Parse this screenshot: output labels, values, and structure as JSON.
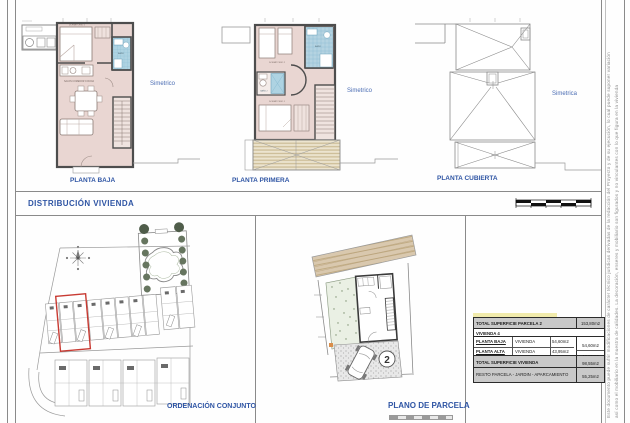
{
  "header": {
    "section_title": "DISTRIBUCIÓN  VIVIENDA"
  },
  "plans": {
    "baja": {
      "label": "PLANTA BAJA",
      "symmetry": "Simetrico"
    },
    "primera": {
      "label": "PLANTA PRIMERA",
      "symmetry": "Simetrico"
    },
    "cubierta": {
      "label": "PLANTA CUBIERTA",
      "symmetry": "Simetrica"
    }
  },
  "rooms": {
    "salon": "SALON COMEDOR COCINA",
    "dormitorio2": "DORMITORIO 2",
    "dormitorio1": "DORMITORIO 1",
    "bano": "BAÑO",
    "bano2": "BAÑO 2"
  },
  "site_plan": {
    "label": "ORDENACIÓN CONJUNTO"
  },
  "parcel_plan": {
    "label": "PLANO DE PARCELA",
    "plot_number": "2"
  },
  "area_table": {
    "parcela_label": "TOTAL SUPERFICIE  PARCELA 2",
    "parcela_value": "153,80m2",
    "vivienda_header": "VIVIENDA  4",
    "rows": [
      {
        "name": "PLANTA BAJA",
        "use": "VIVIENDA",
        "area": "54,60m2",
        "subtotal": "54,60m2"
      },
      {
        "name": "PLANTA ALTA",
        "use": "VIVIENDA",
        "area": "43,95m2",
        "subtotal": "43,95m2"
      }
    ],
    "total_label": "TOTAL SUPERFICIE  VIVIENDA",
    "total_value": "98,55m2",
    "resto_label": "RESTO PARCELA - JARDIN - APARCAMIENTO",
    "resto_value": "55,25m2"
  },
  "disclaimer": {
    "line1": "Este documento puede sufrir modificaciones de carácter técnico jurídicas derivadas de la redacción del Proyecto y de su ejecución, lo cual puede suponer variación",
    "line2": "así como el mobiliario en la muestra de calidades. La decoración, enseres y mobiliario son figurados y no vinculantes con lo que figura en la vivienda"
  },
  "colors": {
    "accent_blue": "#2f55a4",
    "highlight_red": "#c83a32",
    "room_pink": "#e9d6d2",
    "bath_blue": "#aed3e2",
    "terrace_tan": "#cdbd97",
    "garden_green": "#d8e3cd",
    "table_gray": "#c9c9c9"
  }
}
